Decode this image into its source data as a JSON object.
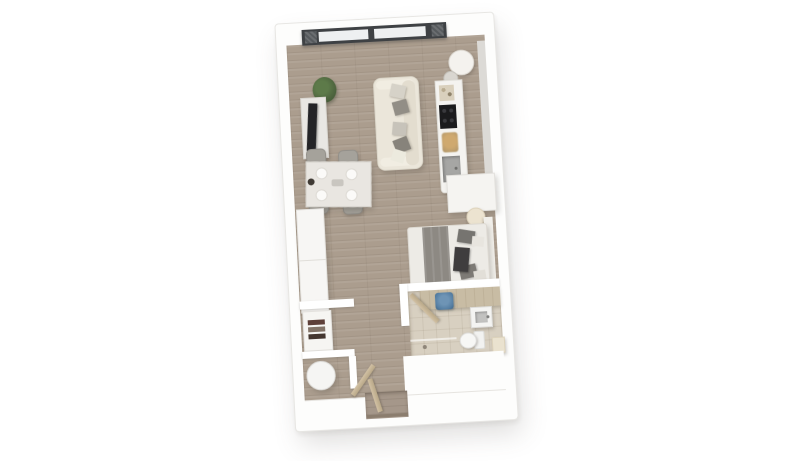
{
  "scene": {
    "type": "3d-floor-plan-render",
    "view": "top-down",
    "subject": "studio-apartment",
    "background": "#ffffff"
  },
  "palette": {
    "background": "#ffffff",
    "wall": "#fdfdfc",
    "wall_edge": "#e7e6e3",
    "wood_floor": "#ab9d8e",
    "bathroom_tile": "#d8d0c1",
    "window_frame": "#3e4144",
    "window_glass": "#eef0f1",
    "window_mesh": "#6b6e71",
    "sofa_cream": "#ebe6da",
    "cushion_gray": "#8f8b83",
    "chair_gray": "#a5a29b",
    "table_marble": "#e9e6e1",
    "wardrobe_white": "#f7f6f4",
    "counter_white": "#f4f3f0",
    "cooktop_black": "#1b1b1d",
    "sink_gray": "#a6a6a4",
    "basket_tan": "#bfa06e",
    "blanket_gray": "#8d8983",
    "nightstand_cream": "#ece3d0",
    "vanity_beige": "#c8bca4",
    "accent_blue": "#567fa3",
    "fixture_white": "#f4f4f2",
    "door_tan": "#c6b494",
    "towel_brown": "#5e4039",
    "plant_green": "#4f663f"
  },
  "rooms": [
    {
      "name": "living-dining-area",
      "floor": "wood",
      "furniture": [
        "window-wall",
        "potted-plant",
        "tv-sideboard",
        "television",
        "sofa",
        "throw-pillow",
        "dining-table",
        "dining-chair",
        "tableware"
      ]
    },
    {
      "name": "kitchen",
      "floor": "wood",
      "furniture": [
        "kitchen-counter",
        "kitchen-sink",
        "cooktop",
        "bread-basket",
        "round-table",
        "stool",
        "tall-cabinet"
      ]
    },
    {
      "name": "sleeping-area",
      "floor": "wood",
      "furniture": [
        "double-bed",
        "gray-blanket",
        "bed-pillow",
        "headboard",
        "nightstand",
        "folded-clothes"
      ]
    },
    {
      "name": "bathroom",
      "floor": "tile",
      "furniture": [
        "vanity-counter",
        "washbasin",
        "blue-laundry-basket",
        "toilet",
        "shower-area",
        "bathroom-door",
        "shower-ledge"
      ]
    },
    {
      "name": "hallway",
      "floor": "wood",
      "furniture": [
        "entry-door",
        "door-threshold"
      ]
    },
    {
      "name": "storage-closet",
      "floor": "wood",
      "furniture": [
        "shelf-unit",
        "folded-towels"
      ]
    },
    {
      "name": "utility-room",
      "floor": "wood",
      "furniture": [
        "washing-machine",
        "utility-door"
      ]
    }
  ]
}
